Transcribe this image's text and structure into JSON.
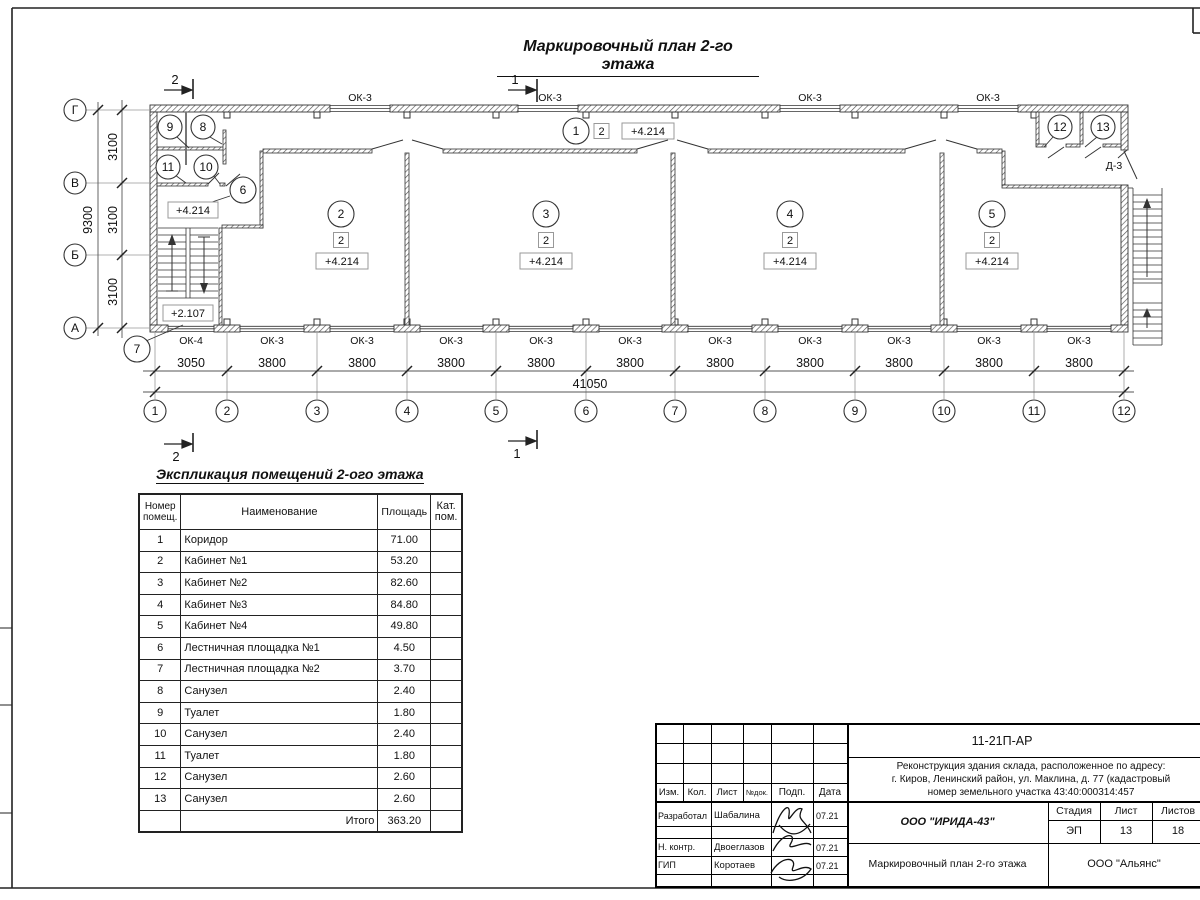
{
  "plan": {
    "title": "Маркировочный план 2-го этажа",
    "sections": {
      "s1": "1",
      "s2": "2"
    },
    "elev_main": "+4.214",
    "elev_stair": "+2.107",
    "badge": "2",
    "door_label": "Д-3",
    "rooms": [
      "1",
      "2",
      "3",
      "4",
      "5",
      "6",
      "7",
      "8",
      "9",
      "10",
      "11",
      "12",
      "13"
    ],
    "axes_h": [
      "1",
      "2",
      "3",
      "4",
      "5",
      "6",
      "7",
      "8",
      "9",
      "10",
      "11",
      "12"
    ],
    "axes_v": [
      "Г",
      "В",
      "Б",
      "А"
    ],
    "dims_bottom": [
      "3050",
      "3800",
      "3800",
      "3800",
      "3800",
      "3800",
      "3800",
      "3800",
      "3800",
      "3800",
      "3800"
    ],
    "dim_total": "41050",
    "dims_left": [
      "3100",
      "3100",
      "3100"
    ],
    "dim_left_total": "9300",
    "windows_top": [
      "ОК-3",
      "ОК-3",
      "ОК-3",
      "ОК-3"
    ],
    "windows_bottom": [
      "ОК-4",
      "ОК-3",
      "ОК-3",
      "ОК-3",
      "ОК-3",
      "ОК-3",
      "ОК-3",
      "ОК-3",
      "ОК-3",
      "ОК-3",
      "ОК-3"
    ]
  },
  "table": {
    "title": "Экспликация помещений 2-ого этажа",
    "headers": {
      "num": "Номер помещ.",
      "name": "Наименование",
      "area": "Площадь",
      "cat": "Кат. пом."
    },
    "rows": [
      {
        "num": "1",
        "name": "Коридор",
        "area": "71.00"
      },
      {
        "num": "2",
        "name": "Кабинет №1",
        "area": "53.20"
      },
      {
        "num": "3",
        "name": "Кабинет №2",
        "area": "82.60"
      },
      {
        "num": "4",
        "name": "Кабинет №3",
        "area": "84.80"
      },
      {
        "num": "5",
        "name": "Кабинет №4",
        "area": "49.80"
      },
      {
        "num": "6",
        "name": "Лестничная площадка №1",
        "area": "4.50"
      },
      {
        "num": "7",
        "name": "Лестничная площадка №2",
        "area": "3.70"
      },
      {
        "num": "8",
        "name": "Санузел",
        "area": "2.40"
      },
      {
        "num": "9",
        "name": "Туалет",
        "area": "1.80"
      },
      {
        "num": "10",
        "name": "Санузел",
        "area": "2.40"
      },
      {
        "num": "11",
        "name": "Туалет",
        "area": "1.80"
      },
      {
        "num": "12",
        "name": "Санузел",
        "area": "2.60"
      },
      {
        "num": "13",
        "name": "Санузел",
        "area": "2.60"
      }
    ],
    "total_label": "Итого",
    "total": "363.20"
  },
  "titleblock": {
    "doc_number": "11-21П-АР",
    "description_lines": [
      "Реконструкция здания склада, расположенное по адресу:",
      "г. Киров, Ленинский район, ул. Маклина, д. 77 (кадастровый",
      "номер земельного участка 43:40:000314:457"
    ],
    "cols": {
      "izm": "Изм.",
      "kol": "Кол.",
      "list": "Лист",
      "doc": "№док.",
      "podp": "Подп.",
      "data": "Дата"
    },
    "roles": [
      {
        "role": "Разработал",
        "name": "Шабалина",
        "date": "07.21"
      },
      {
        "role": "Н. контр.",
        "name": "Двоеглазов",
        "date": "07.21"
      },
      {
        "role": "ГИП",
        "name": "Коротаев",
        "date": "07.21"
      }
    ],
    "company": "ООО \"ИРИДА-43\"",
    "stage": {
      "label": "Стадия",
      "value": "ЭП"
    },
    "sheet": {
      "label": "Лист",
      "value": "13"
    },
    "sheets": {
      "label": "Листов",
      "value": "18"
    },
    "sheet_title": "Маркировочный план 2-го этажа",
    "org": "ООО \"Альянс\""
  }
}
